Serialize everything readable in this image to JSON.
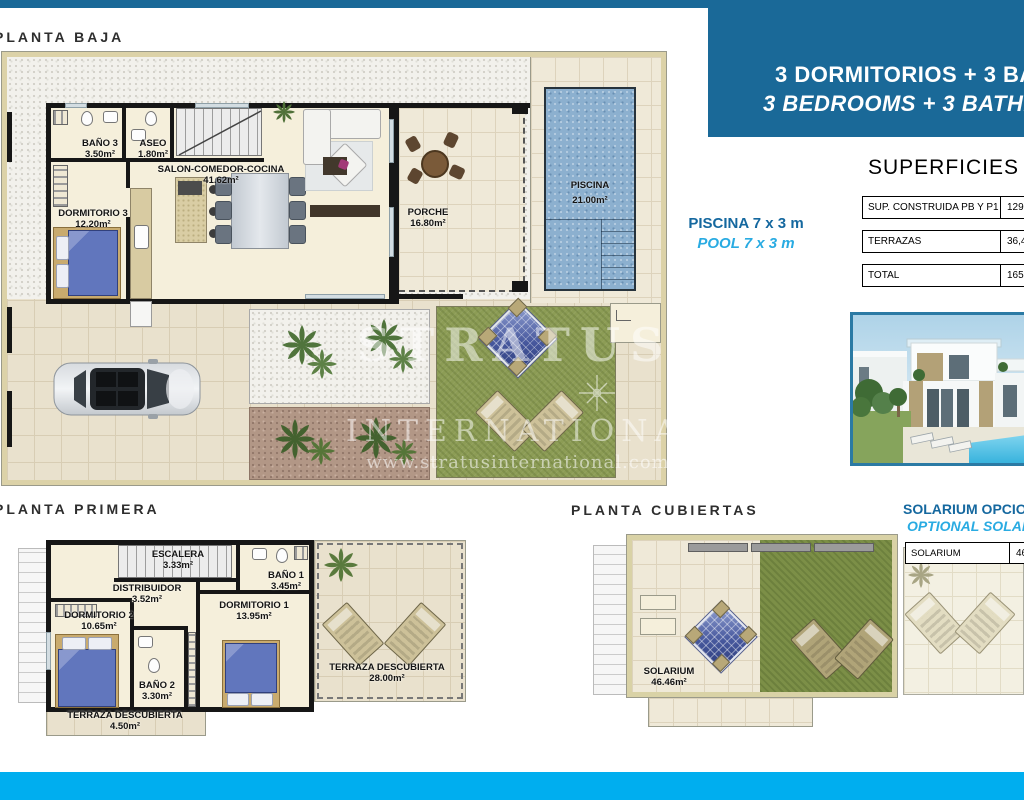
{
  "colors": {
    "brand_blue": "#1a6998",
    "accent_cyan": "#00aeef",
    "caption_blue": "#15689f",
    "caption_cyan": "#29abe2"
  },
  "header": {
    "title_es": "3 DORMITORIOS + 3 BAÑOS",
    "title_en": "3 BEDROOMS + 3 BATHROOMS"
  },
  "planta_baja": {
    "title": "PLANTA BAJA",
    "rooms": [
      {
        "name": "BAÑO 3",
        "area": "3.50m²"
      },
      {
        "name": "ASEO",
        "area": "1.80m²"
      },
      {
        "name": "SALON-COMEDOR-COCINA",
        "area": "41.62m²"
      },
      {
        "name": "DORMITORIO 3",
        "area": "12.20m²"
      },
      {
        "name": "PORCHE",
        "area": "16.80m²"
      },
      {
        "name": "PISCINA",
        "area": "21.00m²"
      }
    ]
  },
  "planta_primera": {
    "title": "PLANTA PRIMERA",
    "rooms": [
      {
        "name": "ESCALERA",
        "area": "3.33m²"
      },
      {
        "name": "DISTRIBUIDOR",
        "area": "3.52m²"
      },
      {
        "name": "BAÑO 1",
        "area": "3.45m²"
      },
      {
        "name": "DORMITORIO 1",
        "area": "13.95m²"
      },
      {
        "name": "DORMITORIO 2",
        "area": "10.65m²"
      },
      {
        "name": "BAÑO 2",
        "area": "3.30m²"
      },
      {
        "name": "TERRAZA DESCUBIERTA",
        "area": "28.00m²"
      },
      {
        "name": "TERRAZA DESCUBIERTA",
        "area": "4.50m²"
      }
    ]
  },
  "planta_cubiertas": {
    "title": "PLANTA CUBIERTAS",
    "rooms": [
      {
        "name": "SOLARIUM",
        "area": "46.46m²"
      }
    ]
  },
  "pool_caption": {
    "es": "PISCINA 7 x 3 m",
    "en": "POOL 7 x 3 m"
  },
  "solarium_caption": {
    "es": "SOLARIUM OPCIONAL",
    "en": "OPTIONAL SOLARIUM"
  },
  "superficies": {
    "title": "SUPERFICIES",
    "rows": [
      {
        "label": "SUP. CONSTRUIDA PB Y P1",
        "value": "129,17"
      },
      {
        "label": "TERRAZAS",
        "value": "36,40"
      },
      {
        "label": "TOTAL",
        "value": "165,57"
      }
    ]
  },
  "solarium_table": {
    "label": "SOLARIUM",
    "value": "46,46"
  },
  "watermark": {
    "name": "STRATUS",
    "sub": "INTERNATIONAL",
    "url": "www.stratusinternational.com"
  }
}
